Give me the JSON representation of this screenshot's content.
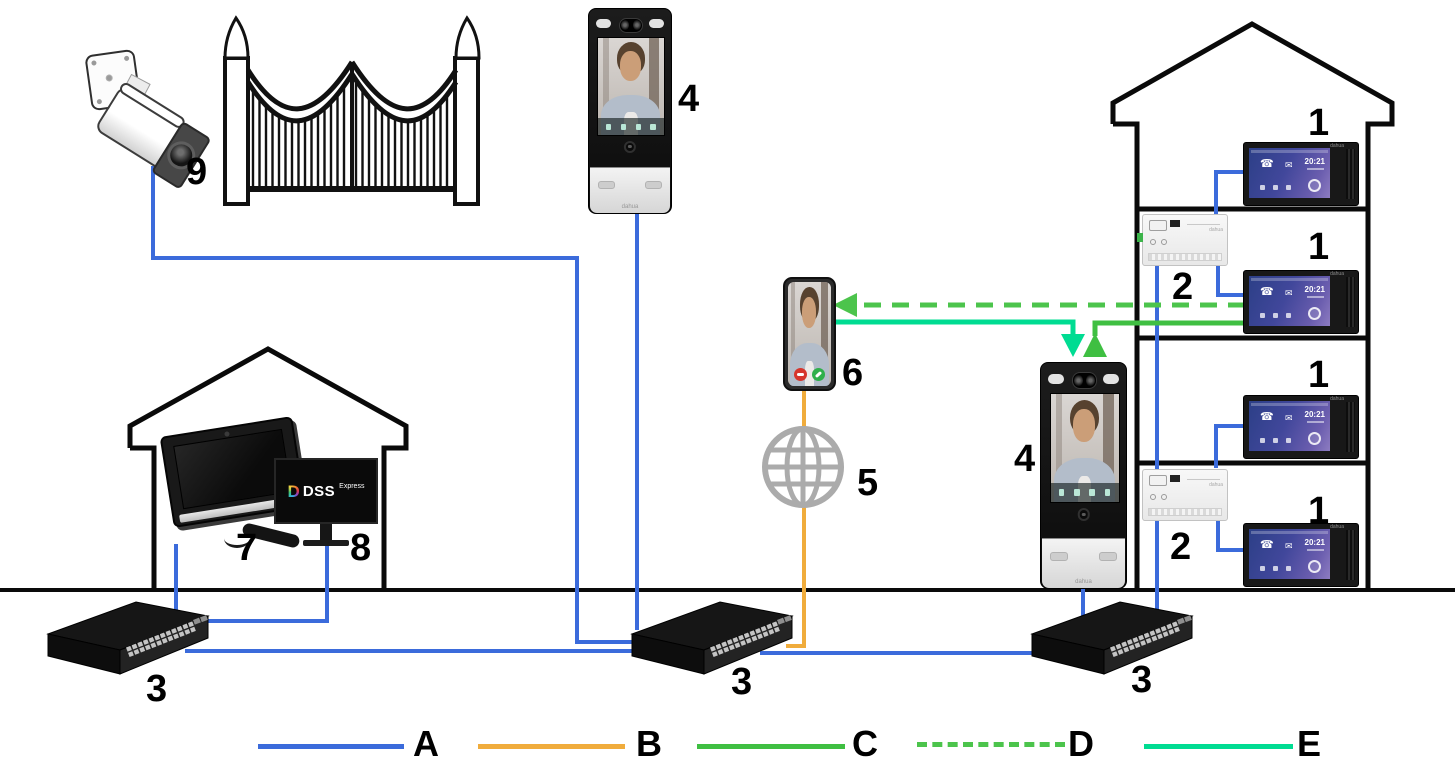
{
  "brand": "dahua",
  "labels": {
    "indoor_monitor": "1",
    "floor_distributor": "2",
    "network_switch": "3",
    "door_station": "4",
    "internet": "5",
    "smartphone": "6",
    "master_station": "7",
    "dss_server": "8",
    "ip_camera": "9"
  },
  "legend": {
    "items": [
      {
        "label": "A",
        "color": "#3b6bdb",
        "dashed": false
      },
      {
        "label": "B",
        "color": "#f0ac3c",
        "dashed": false
      },
      {
        "label": "C",
        "color": "#3fbf42",
        "dashed": false
      },
      {
        "label": "D",
        "color": "#4cc44c",
        "dashed": true
      },
      {
        "label": "E",
        "color": "#00dc92",
        "dashed": false
      }
    ]
  },
  "monitor": {
    "time": "20:21"
  },
  "dss": {
    "logo_letter": "D",
    "name": "DSS",
    "suffix": "Express"
  },
  "icons": {
    "phone": "☎",
    "mail": "✉"
  }
}
